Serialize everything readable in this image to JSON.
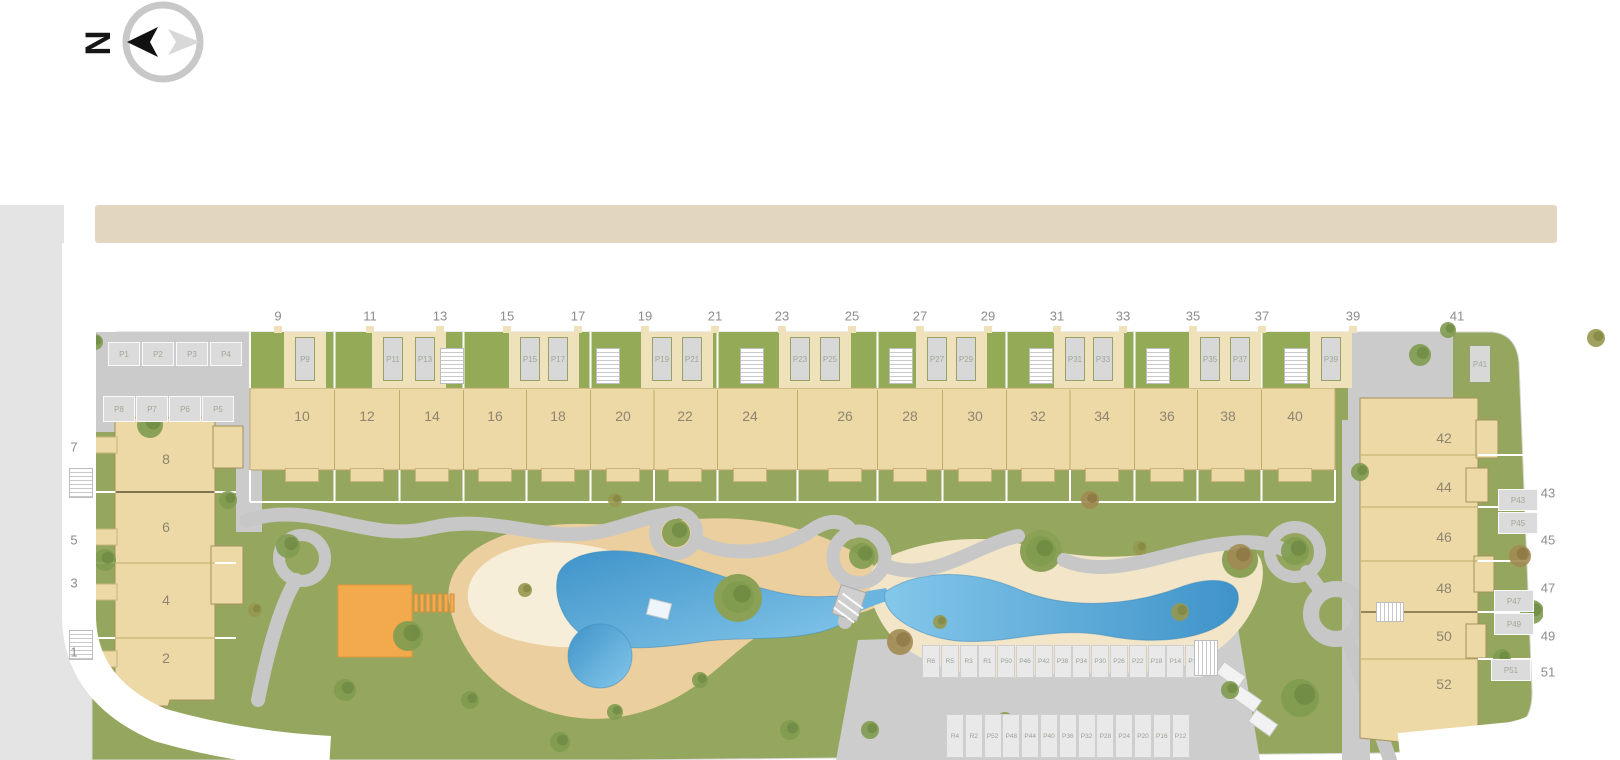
{
  "compass": {
    "letter": "N"
  },
  "colors": {
    "lawn": "#95a75f",
    "sand": "#ebcf9e",
    "sand_light": "#f7eed9",
    "sand_pale": "#f2e5c8",
    "pool_dark": "#3f93c9",
    "pool_light": "#84c7ea",
    "building": "#ecd9a6",
    "building_border": "#a5925c",
    "playground_orange": "#f3aa4c",
    "path_gray": "#c7c7c7",
    "drive_gray": "#cbcbcb",
    "sidewalk_beige": "#e3d6c0",
    "side_gray": "#e4e4e4",
    "parking_gray": "#d8d8d8",
    "label_gray": "#8c8c8c"
  },
  "plan": {
    "street_numbers_top": [
      {
        "label": "9",
        "x": 278
      },
      {
        "label": "11",
        "x": 370
      },
      {
        "label": "13",
        "x": 440
      },
      {
        "label": "15",
        "x": 507
      },
      {
        "label": "17",
        "x": 578
      },
      {
        "label": "19",
        "x": 645
      },
      {
        "label": "21",
        "x": 715
      },
      {
        "label": "23",
        "x": 782
      },
      {
        "label": "25",
        "x": 852
      },
      {
        "label": "27",
        "x": 920
      },
      {
        "label": "29",
        "x": 988
      },
      {
        "label": "31",
        "x": 1057
      },
      {
        "label": "33",
        "x": 1123
      },
      {
        "label": "35",
        "x": 1193
      },
      {
        "label": "37",
        "x": 1262
      },
      {
        "label": "39",
        "x": 1353
      },
      {
        "label": "41",
        "x": 1457
      }
    ],
    "street_numbers_left": [
      {
        "label": "7",
        "y": 447
      },
      {
        "label": "5",
        "y": 540
      },
      {
        "label": "3",
        "y": 583
      },
      {
        "label": "1",
        "y": 652
      }
    ],
    "street_numbers_right": [
      {
        "label": "43",
        "y": 493
      },
      {
        "label": "45",
        "y": 540
      },
      {
        "label": "47",
        "y": 588
      },
      {
        "label": "49",
        "y": 636
      },
      {
        "label": "51",
        "y": 672
      }
    ],
    "block_numbers": [
      {
        "label": "10",
        "x": 302
      },
      {
        "label": "12",
        "x": 367
      },
      {
        "label": "14",
        "x": 432
      },
      {
        "label": "16",
        "x": 495
      },
      {
        "label": "18",
        "x": 558
      },
      {
        "label": "20",
        "x": 623
      },
      {
        "label": "22",
        "x": 685
      },
      {
        "label": "24",
        "x": 750
      },
      {
        "label": "26",
        "x": 845
      },
      {
        "label": "28",
        "x": 910
      },
      {
        "label": "30",
        "x": 975
      },
      {
        "label": "32",
        "x": 1038
      },
      {
        "label": "34",
        "x": 1102
      },
      {
        "label": "36",
        "x": 1167
      },
      {
        "label": "38",
        "x": 1228
      },
      {
        "label": "40",
        "x": 1295
      }
    ],
    "building_numbers_left": [
      {
        "label": "8",
        "y": 459
      },
      {
        "label": "6",
        "y": 527
      },
      {
        "label": "4",
        "y": 600
      },
      {
        "label": "2",
        "y": 658
      }
    ],
    "building_numbers_right": [
      {
        "label": "42",
        "y": 438
      },
      {
        "label": "44",
        "y": 487
      },
      {
        "label": "46",
        "y": 537
      },
      {
        "label": "48",
        "y": 588
      },
      {
        "label": "50",
        "y": 636
      },
      {
        "label": "52",
        "y": 684
      }
    ],
    "parking_top": [
      {
        "label": "P9",
        "x": 305
      },
      {
        "label": "P11",
        "x": 393
      },
      {
        "label": "P13",
        "x": 425
      },
      {
        "label": "P15",
        "x": 530
      },
      {
        "label": "P17",
        "x": 558
      },
      {
        "label": "P19",
        "x": 662
      },
      {
        "label": "P21",
        "x": 692
      },
      {
        "label": "P23",
        "x": 800
      },
      {
        "label": "P25",
        "x": 830
      },
      {
        "label": "P27",
        "x": 937
      },
      {
        "label": "P29",
        "x": 966
      },
      {
        "label": "P31",
        "x": 1075
      },
      {
        "label": "P33",
        "x": 1103
      },
      {
        "label": "P35",
        "x": 1210
      },
      {
        "label": "P37",
        "x": 1240
      },
      {
        "label": "P39",
        "x": 1331
      }
    ],
    "parking_41": {
      "label": "P41"
    },
    "parking_left_row1": [
      "P1",
      "P2",
      "P3",
      "P4"
    ],
    "parking_left_row2": [
      "P8",
      "P7",
      "P6",
      "P5"
    ],
    "parking_right": [
      {
        "label": "P43",
        "x": 1498,
        "y": 489
      },
      {
        "label": "P45",
        "x": 1498,
        "y": 512
      },
      {
        "label": "P47",
        "x": 1494,
        "y": 590
      },
      {
        "label": "P49",
        "x": 1494,
        "y": 613
      },
      {
        "label": "P51",
        "x": 1491,
        "y": 659
      }
    ],
    "parking_bottom_row1": [
      "R6",
      "R5",
      "R3",
      "R1",
      "P50",
      "P46",
      "P42",
      "P38",
      "P34",
      "P30",
      "P26",
      "P22",
      "P18",
      "P14",
      "P10"
    ],
    "parking_bottom_row2": [
      "R4",
      "R2",
      "P52",
      "P48",
      "P44",
      "P40",
      "P36",
      "P32",
      "P28",
      "P24",
      "P20",
      "P16",
      "P12"
    ]
  }
}
